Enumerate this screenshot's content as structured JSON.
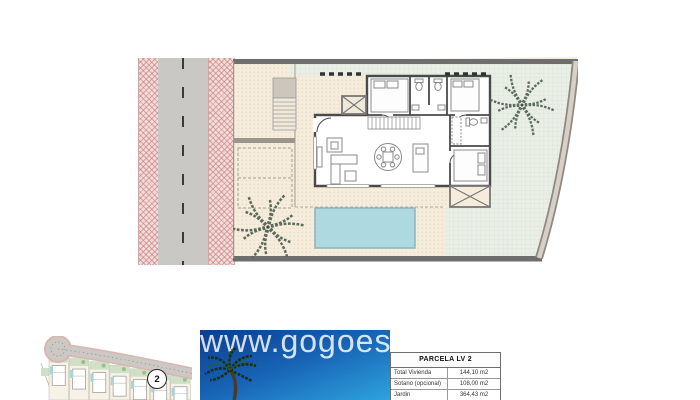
{
  "canvas": {
    "background": "#ffffff"
  },
  "main_plan": {
    "description": "Villa parcel site plan: road at left, single-storey house with three bedrooms, pool, terrace and palm garden",
    "colors": {
      "road_asphalt": "#c9c8c5",
      "sidewalk_pink": "#f2dbd9",
      "terrace_beige": "#f5ecdc",
      "garden_green": "#e9efe6",
      "pool_blue": "#aed9e0",
      "boundary_wall": "#6e6e6e",
      "house_wall": "#4a4a4a",
      "palm": "#5c6b5e"
    }
  },
  "mini_map": {
    "badge_number": "2",
    "parcel_count": "7"
  },
  "photo": {
    "watermark": "www.gogoes"
  },
  "parcel_table": {
    "title": "PARCELA LV 2",
    "rows": [
      {
        "label": "Total Vivienda",
        "value": "144,10 m2"
      },
      {
        "label": "Sotano (opcional)",
        "value": "108,00 m2"
      },
      {
        "label": "Jardin",
        "value": "364,43 m2"
      }
    ]
  }
}
